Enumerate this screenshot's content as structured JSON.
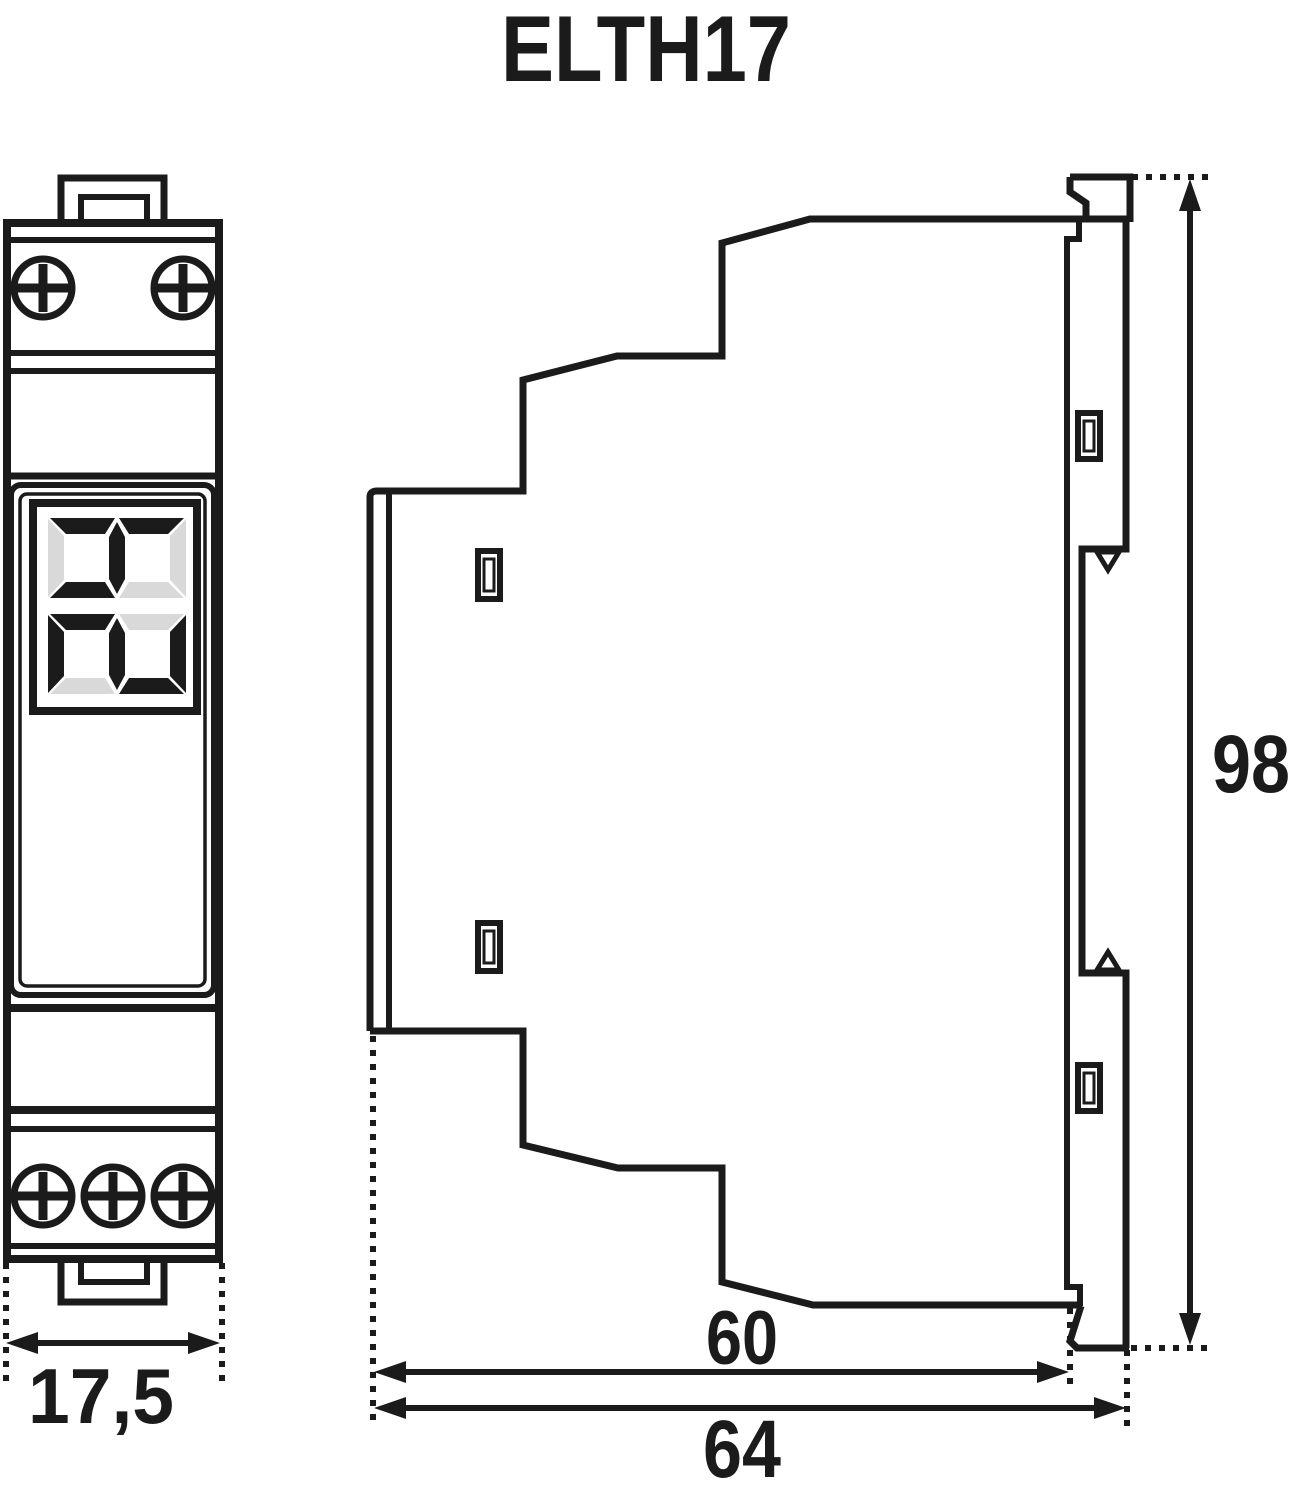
{
  "title": "ELTH17",
  "dimension_labels": {
    "front_width": "17,5",
    "side_height": "98",
    "side_depth_body": "60",
    "side_depth_total": "64"
  },
  "display": {
    "digits_top_to_bottom": [
      "4",
      "2"
    ],
    "reading_when_rotated": "24"
  },
  "colors": {
    "line": "#1b1b1b",
    "segment_off": "#d9d9d9",
    "background": "#ffffff"
  }
}
